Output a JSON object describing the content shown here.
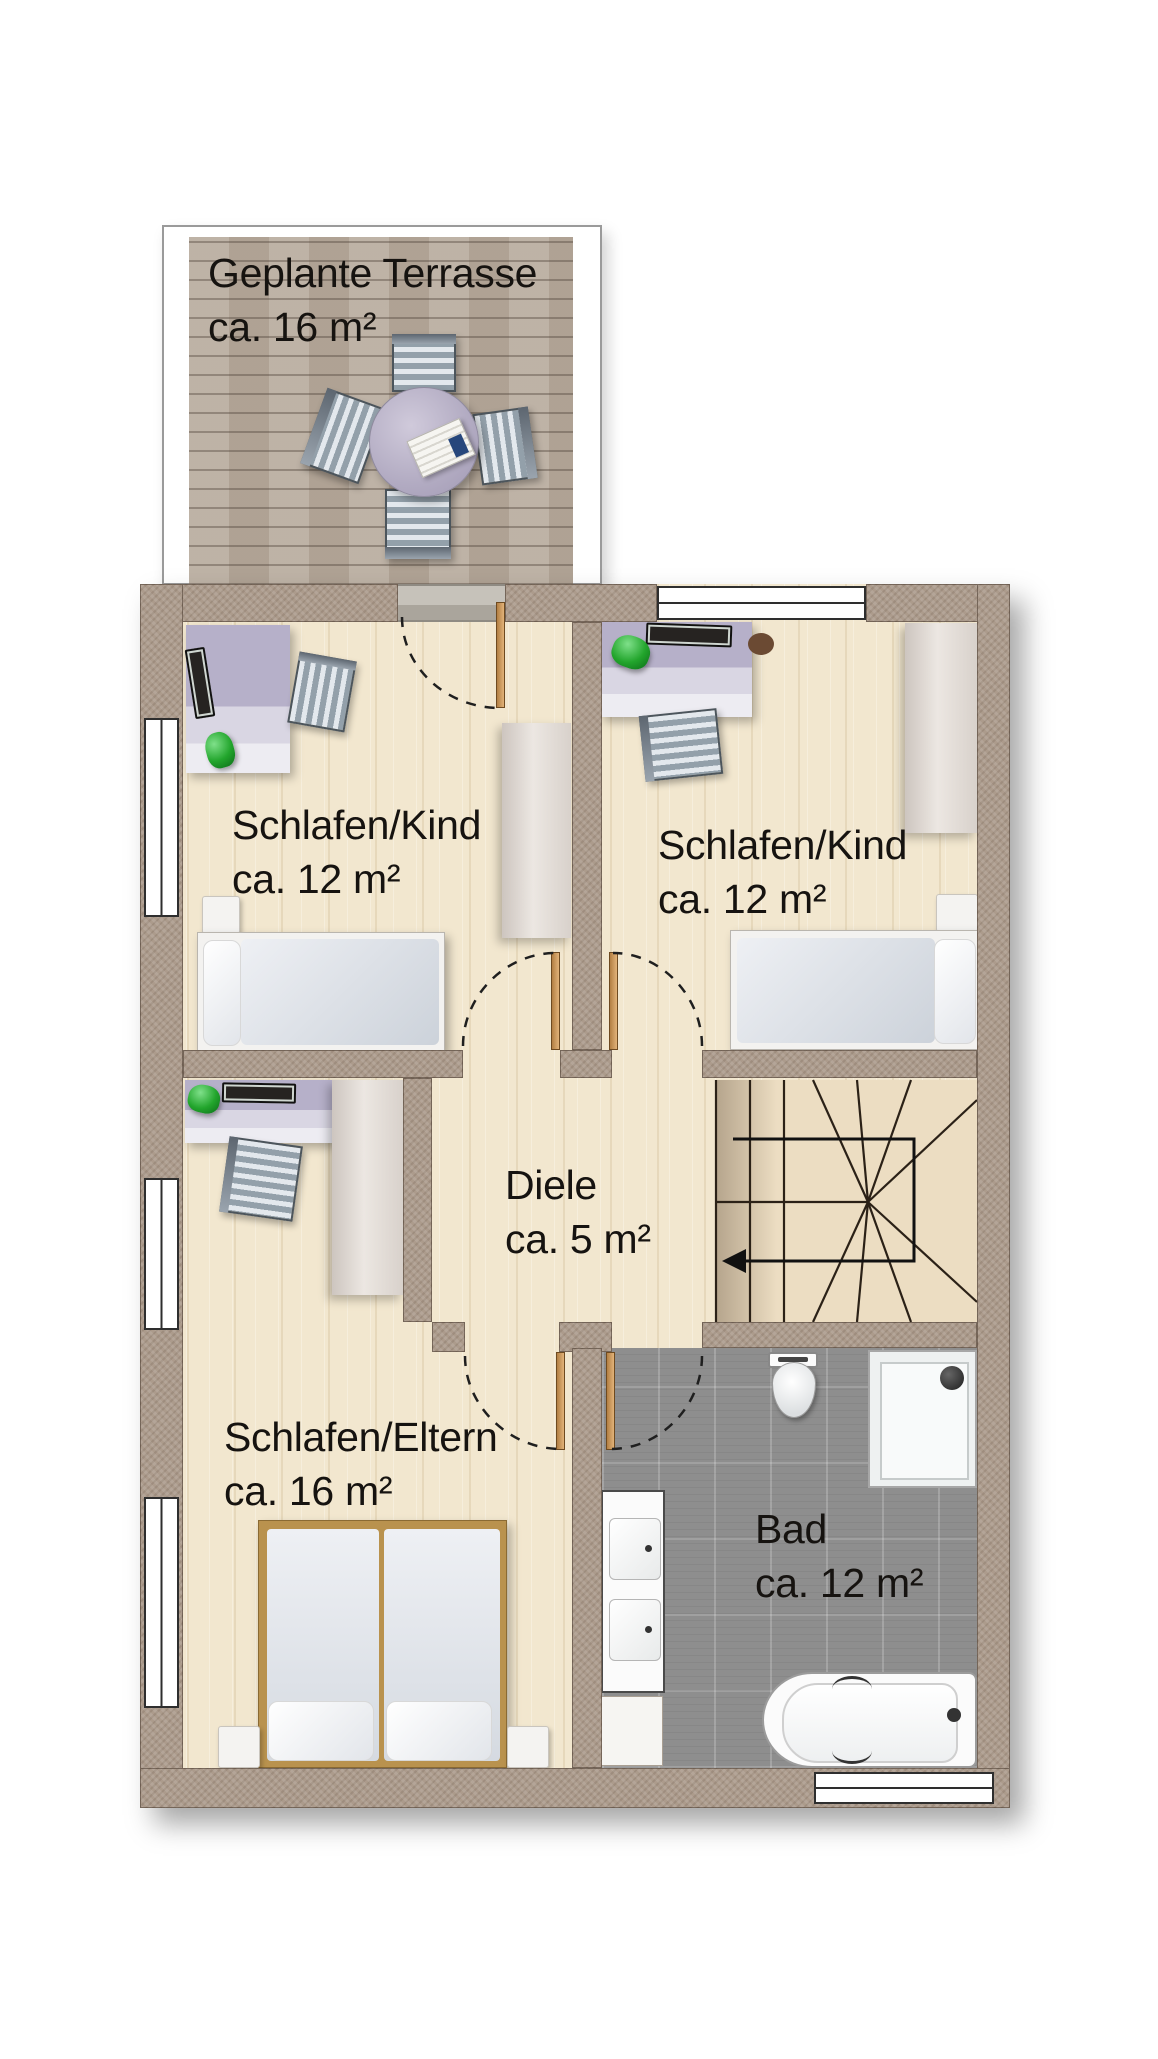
{
  "rooms": {
    "terrasse": {
      "name": "Geplante Terrasse",
      "area": "ca. 16 m²"
    },
    "kind1": {
      "name": "Schlafen/Kind",
      "area": "ca. 12 m²"
    },
    "kind2": {
      "name": "Schlafen/Kind",
      "area": "ca. 12 m²"
    },
    "diele": {
      "name": "Diele",
      "area": "ca. 5 m²"
    },
    "eltern": {
      "name": "Schlafen/Eltern",
      "area": "ca. 16 m²"
    },
    "bad": {
      "name": "Bad",
      "area": "ca. 12 m²"
    }
  },
  "palette": {
    "wall": "#ac9b8c",
    "floor_wood": "#f2e7cf",
    "deck": "#b7aa9c",
    "bath_tile": "#8e8e8e",
    "door_leaf": "#cf9a5e",
    "desk_top": "#b6b0c9",
    "lamp_green": "#22a52c",
    "stair_tread": "#ecddc2",
    "swing_arc": "#1f1f1f",
    "label_text": "#161310",
    "window": "#ffffff",
    "fixture_white": "#fbfbfb"
  }
}
